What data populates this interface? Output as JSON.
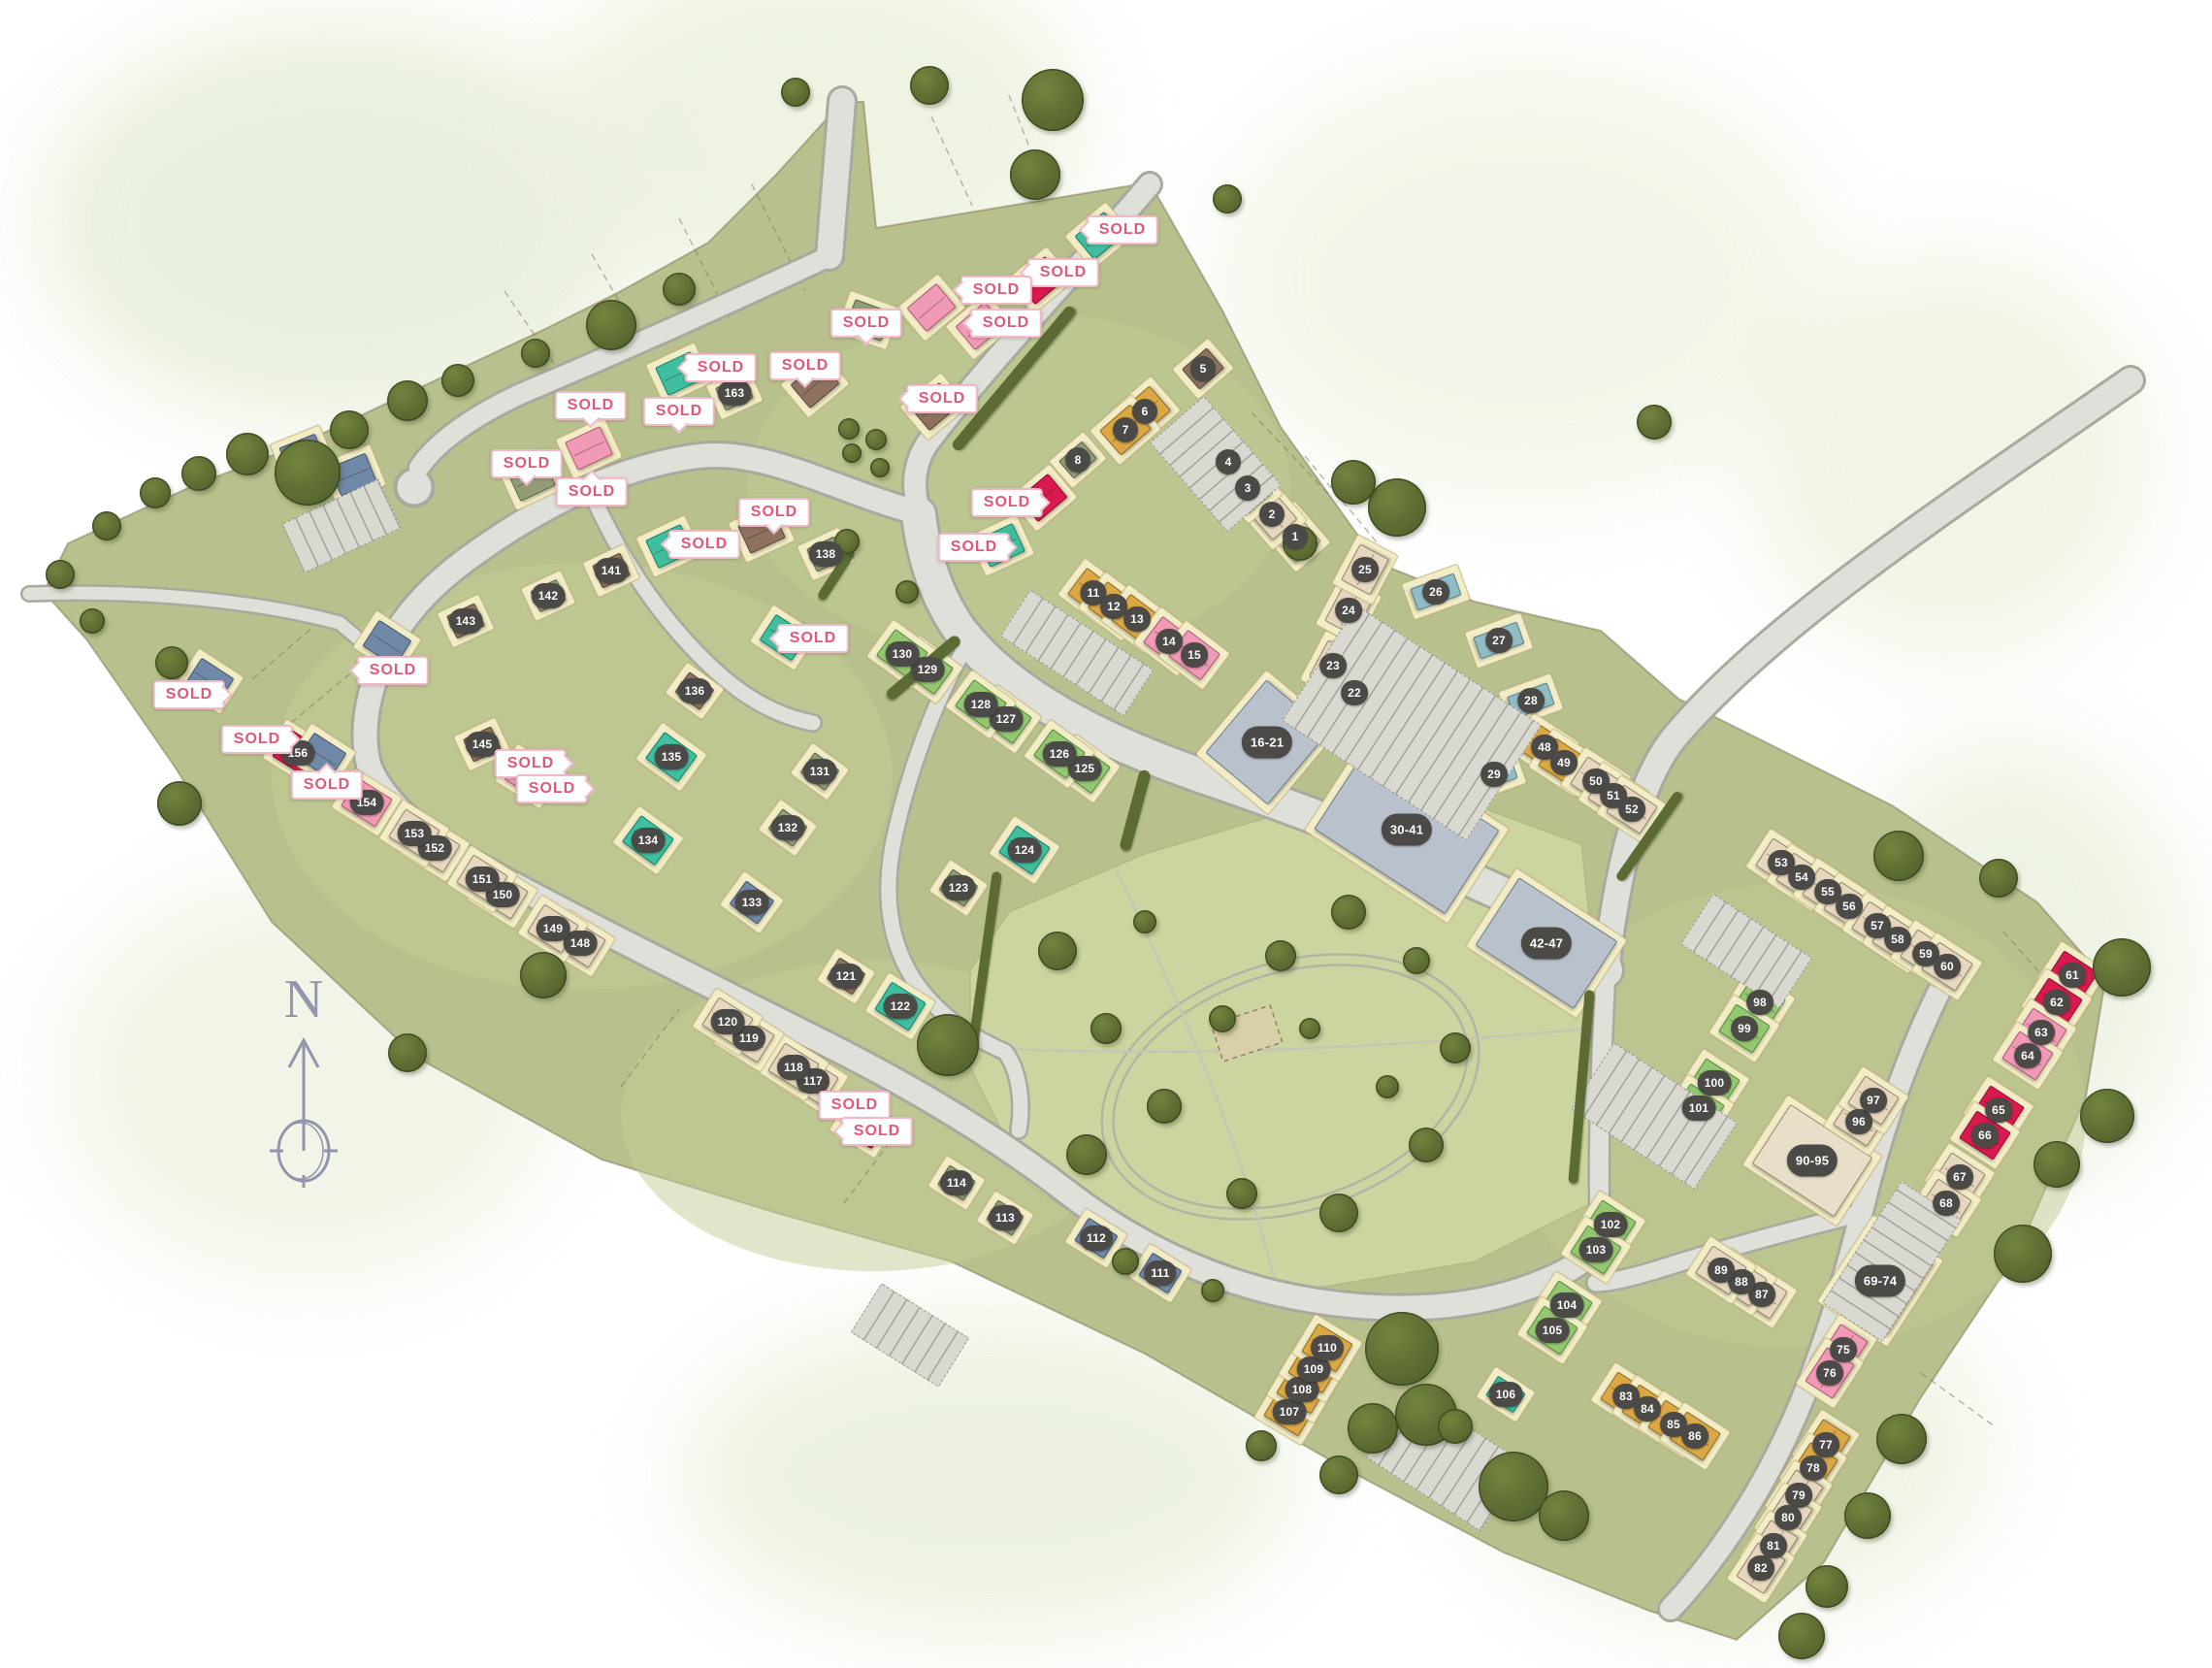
{
  "labels": {
    "sold": "SOLD"
  },
  "compass": {
    "label": "N"
  },
  "colors": {
    "be": [
      "#e7d7be",
      "#93846e"
    ],
    "br": [
      "#8d7260",
      "#594538"
    ],
    "go": [
      "#dca845",
      "#8f6a1e"
    ],
    "sa": [
      "#929d77",
      "#5a6647"
    ],
    "lg": [
      "#93c871",
      "#55893a"
    ],
    "te": [
      "#3fbfa0",
      "#15806a"
    ],
    "st": [
      "#90bcc6",
      "#567f8c"
    ],
    "pi": [
      "#f09ab5",
      "#b25578"
    ],
    "re": [
      "#d91a4e",
      "#8e0c33"
    ],
    "bl": [
      "#7189a8",
      "#42546f"
    ],
    "ga": [
      "#b9c2cc",
      "#6f7c8c"
    ],
    "ba": [
      "#e8dfc8",
      "#9a8d74"
    ]
  },
  "plots": [
    [
      "1",
      "be",
      1335,
      553,
      49
    ],
    [
      "2",
      "be",
      1311,
      530,
      49
    ],
    [
      "3",
      "be",
      1286,
      503,
      49
    ],
    [
      "4",
      "be",
      1266,
      476,
      49
    ],
    [
      "5",
      "br",
      1240,
      380,
      -41,
      48,
      40
    ],
    [
      "6",
      "go",
      1180,
      424,
      -41
    ],
    [
      "7",
      "go",
      1160,
      443,
      -41
    ],
    [
      "8",
      "sa",
      1111,
      474,
      -41,
      46,
      36
    ],
    [
      "11",
      "go",
      1127,
      611,
      37
    ],
    [
      "12",
      "go",
      1148,
      625,
      37
    ],
    [
      "13",
      "go",
      1172,
      638,
      37
    ],
    [
      "14",
      "pi",
      1205,
      661,
      37
    ],
    [
      "15",
      "pi",
      1231,
      675,
      37
    ],
    [
      "16-21",
      "ga",
      1306,
      765,
      -50,
      112,
      96
    ],
    [
      "22",
      "st",
      1396,
      714,
      -62,
      42,
      34
    ],
    [
      "23",
      "be",
      1374,
      686,
      -62
    ],
    [
      "24",
      "be",
      1390,
      629,
      -62
    ],
    [
      "25",
      "be",
      1407,
      587,
      -62
    ],
    [
      "26",
      "st",
      1480,
      610,
      70,
      38,
      60
    ],
    [
      "27",
      "st",
      1545,
      660,
      70,
      38,
      60
    ],
    [
      "28",
      "st",
      1578,
      722,
      70,
      38,
      56
    ],
    [
      "29",
      "st",
      1540,
      798,
      70,
      38,
      56
    ],
    [
      "30-41",
      "ga",
      1450,
      855,
      33,
      175,
      115
    ],
    [
      "42-47",
      "ga",
      1594,
      972,
      33,
      135,
      95
    ],
    [
      "48",
      "go",
      1592,
      770,
      33
    ],
    [
      "49",
      "go",
      1612,
      786,
      33
    ],
    [
      "50",
      "be",
      1645,
      805,
      33
    ],
    [
      "51",
      "be",
      1663,
      820,
      33
    ],
    [
      "52",
      "be",
      1682,
      834,
      33
    ],
    [
      "53",
      "be",
      1836,
      889,
      33
    ],
    [
      "54",
      "be",
      1857,
      904,
      33
    ],
    [
      "55",
      "be",
      1884,
      919,
      33
    ],
    [
      "56",
      "be",
      1906,
      934,
      33
    ],
    [
      "57",
      "be",
      1935,
      954,
      33
    ],
    [
      "58",
      "be",
      1956,
      968,
      33
    ],
    [
      "59",
      "be",
      1985,
      983,
      33
    ],
    [
      "60",
      "be",
      2007,
      996,
      33
    ],
    [
      "61",
      "re",
      2136,
      1005,
      33
    ],
    [
      "62",
      "re",
      2120,
      1033,
      33
    ],
    [
      "63",
      "pi",
      2104,
      1064,
      33
    ],
    [
      "64",
      "pi",
      2090,
      1088,
      33
    ],
    [
      "65",
      "re",
      2060,
      1144,
      33
    ],
    [
      "66",
      "re",
      2046,
      1170,
      33
    ],
    [
      "67",
      "be",
      2020,
      1213,
      33
    ],
    [
      "68",
      "be",
      2006,
      1240,
      33
    ],
    [
      "69-74",
      "ba",
      1938,
      1320,
      -57,
      105,
      85
    ],
    [
      "75",
      "pi",
      1900,
      1391,
      -57
    ],
    [
      "76",
      "pi",
      1886,
      1415,
      -57
    ],
    [
      "77",
      "go",
      1882,
      1489,
      -57
    ],
    [
      "78",
      "go",
      1869,
      1513,
      -57
    ],
    [
      "79",
      "be",
      1854,
      1541,
      -57
    ],
    [
      "80",
      "be",
      1843,
      1564,
      -57
    ],
    [
      "81",
      "be",
      1828,
      1593,
      -57
    ],
    [
      "82",
      "be",
      1815,
      1616,
      -57
    ],
    [
      "83",
      "go",
      1676,
      1439,
      33
    ],
    [
      "84",
      "go",
      1698,
      1452,
      33
    ],
    [
      "85",
      "go",
      1725,
      1468,
      33
    ],
    [
      "86",
      "go",
      1747,
      1480,
      33
    ],
    [
      "87",
      "be",
      1816,
      1334,
      33
    ],
    [
      "88",
      "be",
      1795,
      1321,
      33
    ],
    [
      "89",
      "be",
      1774,
      1309,
      33
    ],
    [
      "90-95",
      "ba",
      1868,
      1196,
      33,
      115,
      85
    ],
    [
      "96",
      "be",
      1916,
      1156,
      33
    ],
    [
      "97",
      "be",
      1931,
      1134,
      33
    ],
    [
      "98",
      "lg",
      1814,
      1033,
      33
    ],
    [
      "99",
      "lg",
      1798,
      1060,
      33
    ],
    [
      "100",
      "lg",
      1767,
      1116,
      33
    ],
    [
      "101",
      "lg",
      1751,
      1142,
      33
    ],
    [
      "102",
      "lg",
      1660,
      1262,
      33
    ],
    [
      "103",
      "lg",
      1645,
      1288,
      33
    ],
    [
      "104",
      "lg",
      1615,
      1345,
      33
    ],
    [
      "105",
      "lg",
      1600,
      1371,
      33
    ],
    [
      "106",
      "te",
      1552,
      1437,
      33,
      48,
      36
    ],
    [
      "107",
      "go",
      1329,
      1455,
      31
    ],
    [
      "108",
      "go",
      1342,
      1432,
      31
    ],
    [
      "109",
      "go",
      1354,
      1411,
      31
    ],
    [
      "110",
      "go",
      1368,
      1389,
      31
    ],
    [
      "111",
      "bl",
      1196,
      1312,
      32,
      50,
      40
    ],
    [
      "112",
      "bl",
      1130,
      1276,
      32,
      50,
      40
    ],
    [
      "113",
      "sa",
      1036,
      1255,
      32,
      46,
      36
    ],
    [
      "114",
      "sa",
      986,
      1219,
      32,
      46,
      36
    ],
    [
      "117",
      "be",
      838,
      1114,
      32
    ],
    [
      "118",
      "be",
      818,
      1100,
      32
    ],
    [
      "119",
      "be",
      772,
      1070,
      32
    ],
    [
      "120",
      "be",
      750,
      1053,
      32
    ],
    [
      "121",
      "br",
      872,
      1006,
      32,
      46,
      38
    ],
    [
      "122",
      "te",
      928,
      1037,
      32
    ],
    [
      "123",
      "sa",
      988,
      915,
      34,
      46,
      38
    ],
    [
      "124",
      "te",
      1056,
      876,
      34
    ],
    [
      "125",
      "lg",
      1118,
      792,
      36
    ],
    [
      "126",
      "lg",
      1092,
      777,
      36
    ],
    [
      "127",
      "lg",
      1037,
      741,
      36
    ],
    [
      "128",
      "lg",
      1011,
      726,
      36
    ],
    [
      "129",
      "lg",
      956,
      690,
      36
    ],
    [
      "130",
      "lg",
      930,
      674,
      36
    ],
    [
      "131",
      "sa",
      845,
      795,
      36,
      46,
      38
    ],
    [
      "132",
      "sa",
      812,
      853,
      36,
      46,
      38
    ],
    [
      "133",
      "bl",
      775,
      930,
      36,
      50,
      42
    ],
    [
      "134",
      "te",
      668,
      866,
      36
    ],
    [
      "135",
      "te",
      692,
      780,
      36
    ],
    [
      "136",
      "br",
      716,
      712,
      36,
      46,
      38
    ],
    [
      "138",
      "sa",
      851,
      571,
      -25,
      46,
      38
    ],
    [
      "141",
      "br",
      630,
      588,
      -25,
      46,
      38
    ],
    [
      "142",
      "sa",
      565,
      614,
      -25,
      44,
      36
    ],
    [
      "143",
      "br",
      480,
      640,
      -25,
      46,
      38
    ],
    [
      "145",
      "br",
      497,
      767,
      -25,
      46,
      38
    ],
    [
      "148",
      "be",
      598,
      972,
      32
    ],
    [
      "149",
      "be",
      570,
      957,
      32
    ],
    [
      "150",
      "be",
      518,
      922,
      32
    ],
    [
      "151",
      "be",
      497,
      906,
      32
    ],
    [
      "152",
      "be",
      448,
      874,
      32
    ],
    [
      "153",
      "be",
      427,
      859,
      32
    ],
    [
      "154",
      "pi",
      378,
      827,
      32
    ],
    [
      "156",
      "re",
      307,
      776,
      32
    ],
    [
      "163",
      "sa",
      757,
      405,
      -25,
      46,
      38
    ]
  ],
  "sold_houses": [
    [
      "te",
      1133,
      243,
      -40
    ],
    [
      "te",
      700,
      385,
      -25
    ],
    [
      "te",
      690,
      563,
      -25
    ],
    [
      "te",
      808,
      657,
      33
    ],
    [
      "te",
      1032,
      562,
      -25
    ],
    [
      "re",
      1072,
      289,
      -40
    ],
    [
      "re",
      1075,
      513,
      -40
    ],
    [
      "re",
      890,
      1160,
      32
    ],
    [
      "pi",
      960,
      317,
      -40
    ],
    [
      "pi",
      1010,
      336,
      -40
    ],
    [
      "pi",
      607,
      462,
      -25
    ],
    [
      "pi",
      545,
      800,
      32
    ],
    [
      "sa",
      895,
      330,
      20
    ],
    [
      "sa",
      548,
      494,
      -25
    ],
    [
      "br",
      840,
      396,
      -40
    ],
    [
      "br",
      785,
      548,
      -25
    ],
    [
      "br",
      963,
      419,
      -40
    ],
    [
      "bl",
      216,
      702,
      33
    ],
    [
      "bl",
      332,
      779,
      33
    ],
    [
      "bl",
      399,
      663,
      33
    ],
    [
      "bl",
      312,
      469,
      -22
    ],
    [
      "bl",
      364,
      489,
      -22
    ]
  ],
  "sold_badges": [
    [
      1157,
      237,
      "l"
    ],
    [
      1096,
      281,
      "l"
    ],
    [
      1027,
      299,
      "l"
    ],
    [
      1037,
      333,
      "l"
    ],
    [
      893,
      333,
      "d"
    ],
    [
      830,
      377,
      "d"
    ],
    [
      971,
      411,
      "l"
    ],
    [
      743,
      379,
      "l"
    ],
    [
      609,
      418,
      "d"
    ],
    [
      700,
      424,
      "d"
    ],
    [
      543,
      478,
      "d"
    ],
    [
      610,
      507,
      "u"
    ],
    [
      726,
      561,
      "l"
    ],
    [
      798,
      528,
      "d"
    ],
    [
      838,
      658,
      "l"
    ],
    [
      1004,
      564,
      "r"
    ],
    [
      1038,
      518,
      "r"
    ],
    [
      195,
      716,
      "r"
    ],
    [
      265,
      762,
      "r"
    ],
    [
      337,
      809,
      "u"
    ],
    [
      405,
      691,
      "l"
    ],
    [
      547,
      787,
      "r"
    ],
    [
      569,
      813,
      "r"
    ],
    [
      881,
      1139,
      "d"
    ],
    [
      904,
      1166,
      "l"
    ]
  ],
  "trees": [
    [
      317,
      487,
      34
    ],
    [
      255,
      468,
      22
    ],
    [
      205,
      488,
      18
    ],
    [
      160,
      508,
      16
    ],
    [
      110,
      542,
      15
    ],
    [
      360,
      443,
      20
    ],
    [
      420,
      413,
      21
    ],
    [
      472,
      392,
      17
    ],
    [
      552,
      364,
      15
    ],
    [
      630,
      335,
      26
    ],
    [
      700,
      298,
      17
    ],
    [
      1085,
      103,
      32
    ],
    [
      958,
      88,
      20
    ],
    [
      1067,
      180,
      26
    ],
    [
      820,
      95,
      15
    ],
    [
      1265,
      205,
      15
    ],
    [
      1440,
      523,
      30
    ],
    [
      1395,
      497,
      23
    ],
    [
      1340,
      560,
      18
    ],
    [
      875,
      442,
      11
    ],
    [
      903,
      453,
      11
    ],
    [
      878,
      467,
      10
    ],
    [
      907,
      482,
      10
    ],
    [
      873,
      558,
      13
    ],
    [
      935,
      610,
      12
    ],
    [
      177,
      683,
      17
    ],
    [
      185,
      828,
      23
    ],
    [
      95,
      640,
      13
    ],
    [
      62,
      592,
      15
    ],
    [
      560,
      1005,
      24
    ],
    [
      977,
      1077,
      32
    ],
    [
      420,
      1085,
      20
    ],
    [
      1090,
      980,
      20
    ],
    [
      1140,
      1060,
      16
    ],
    [
      1200,
      1140,
      18
    ],
    [
      1120,
      1190,
      21
    ],
    [
      1260,
      1050,
      14
    ],
    [
      1320,
      985,
      16
    ],
    [
      1390,
      940,
      18
    ],
    [
      1460,
      990,
      14
    ],
    [
      1500,
      1080,
      16
    ],
    [
      1470,
      1180,
      18
    ],
    [
      1380,
      1250,
      20
    ],
    [
      1280,
      1230,
      16
    ],
    [
      1180,
      950,
      12
    ],
    [
      1350,
      1060,
      11
    ],
    [
      1430,
      1120,
      12
    ],
    [
      1160,
      1300,
      14
    ],
    [
      1250,
      1330,
      12
    ],
    [
      1445,
      1390,
      38
    ],
    [
      1470,
      1458,
      32
    ],
    [
      1415,
      1472,
      26
    ],
    [
      1560,
      1532,
      36
    ],
    [
      1612,
      1562,
      26
    ],
    [
      1500,
      1470,
      18
    ],
    [
      1380,
      1520,
      20
    ],
    [
      1300,
      1490,
      16
    ],
    [
      1957,
      882,
      26
    ],
    [
      2060,
      905,
      20
    ],
    [
      2187,
      997,
      30
    ],
    [
      2172,
      1150,
      28
    ],
    [
      2120,
      1200,
      24
    ],
    [
      2085,
      1292,
      30
    ],
    [
      1705,
      435,
      18
    ],
    [
      1960,
      1483,
      26
    ],
    [
      1925,
      1562,
      24
    ],
    [
      1883,
      1635,
      22
    ],
    [
      1857,
      1686,
      24
    ]
  ],
  "hedges": [
    [
      1045,
      390,
      190,
      12,
      -50
    ],
    [
      1170,
      835,
      12,
      85,
      15
    ],
    [
      1015,
      990,
      10,
      185,
      8
    ],
    [
      1630,
      1120,
      10,
      200,
      5
    ],
    [
      1700,
      862,
      110,
      10,
      -55
    ],
    [
      952,
      688,
      12,
      95,
      50
    ],
    [
      862,
      592,
      10,
      60,
      33
    ]
  ],
  "parking": [
    [
      1110,
      673,
      150,
      55,
      33
    ],
    [
      1455,
      745,
      225,
      140,
      33
    ],
    [
      1253,
      478,
      120,
      72,
      49
    ],
    [
      1705,
      1150,
      150,
      80,
      33
    ],
    [
      1950,
      1300,
      148,
      72,
      -57
    ],
    [
      1490,
      1505,
      140,
      82,
      33
    ],
    [
      352,
      542,
      108,
      54,
      -25
    ],
    [
      938,
      1376,
      105,
      58,
      32
    ],
    [
      1800,
      980,
      120,
      60,
      33
    ]
  ]
}
